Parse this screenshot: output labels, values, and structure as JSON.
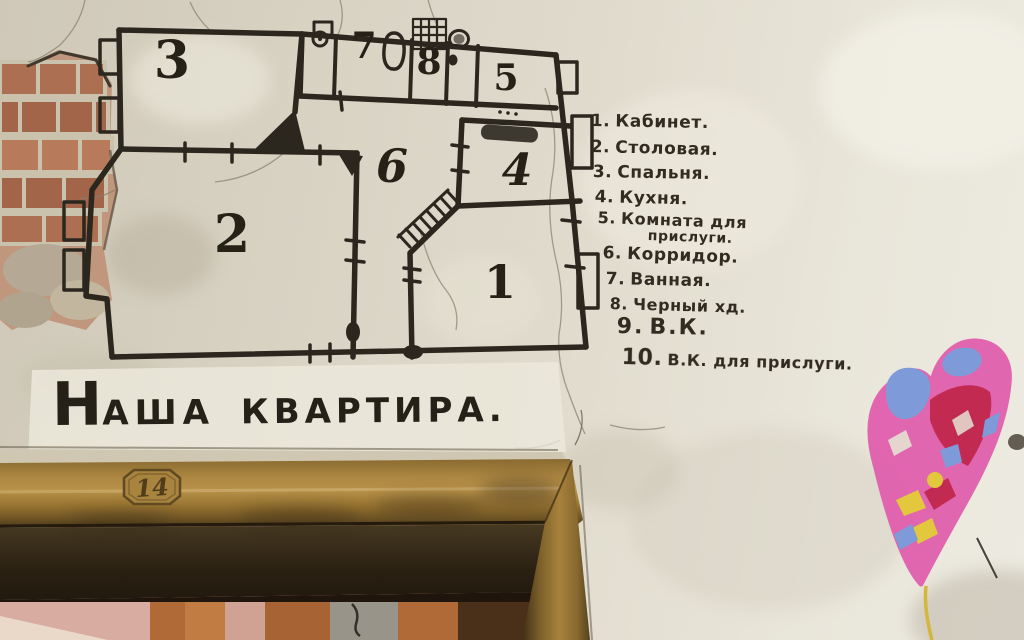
{
  "scene": {
    "description": "Hand-drawn floor plan of an old apartment painted in black ink on a cracked plaster wall above a doorway, captioned 'Наша квартира' (Our apartment), with a numbered room legend in Russian and pink lips graffiti"
  },
  "title": {
    "initial": "Н",
    "rest": "АША",
    "word2": "КВАРТИРА."
  },
  "plan": {
    "numbers": {
      "n1": "1",
      "n2": "2",
      "n3": "3",
      "n4": "4",
      "n5": "5",
      "n6": "6",
      "n7": "7",
      "n8": "8"
    }
  },
  "legend": {
    "lines": [
      {
        "n": "1.",
        "t": "Кабинет."
      },
      {
        "n": "2.",
        "t": "Столовая."
      },
      {
        "n": "3.",
        "t": "Спальня."
      },
      {
        "n": "4.",
        "t": "Кухня."
      },
      {
        "n": "5.",
        "t": "Комната для"
      },
      {
        "n": "",
        "t": "прислуги."
      },
      {
        "n": "6.",
        "t": "Корридор."
      },
      {
        "n": "7.",
        "t": "Ванная."
      },
      {
        "n": "8.",
        "t": "Черный хд."
      },
      {
        "n": "9.",
        "t": "В.К."
      },
      {
        "n": "10.",
        "t": "В.К. для прислуги."
      }
    ]
  },
  "door": {
    "plate": "14"
  },
  "colors": {
    "ink": "#2b271f",
    "wall": "#dcd6c8",
    "brick": "#ad6f52",
    "door_wood": "#a8843f",
    "graffiti_pink": "#e05bac",
    "graffiti_blue": "#7e9ad9",
    "graffiti_red": "#c22a52",
    "graffiti_yellow": "#e3c83d"
  }
}
